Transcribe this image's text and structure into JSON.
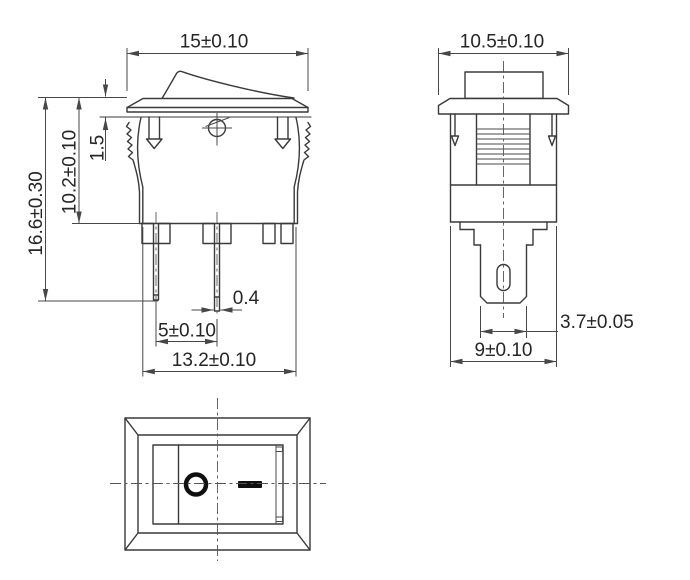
{
  "colors": {
    "background": "#ffffff",
    "outline": "#3a3a3a",
    "dimension_line": "#474747",
    "text": "#262626",
    "marking": "#101010"
  },
  "views": {
    "front": {
      "dims": {
        "top_width": "15±0.10",
        "overall_height": "16.6±0.30",
        "body_height": "10.2±0.10",
        "flange_thickness": "1.5",
        "terminal_thickness": "0.4",
        "terminal_pitch": "5±0.10",
        "bottom_width": "13.2±0.10"
      }
    },
    "side": {
      "dims": {
        "top_width": "10.5±0.10",
        "terminal_width": "3.7±0.05",
        "body_width": "9±0.10"
      }
    },
    "bottom": {
      "markings": {
        "off_symbol": "O",
        "on_symbol": "—"
      }
    }
  }
}
